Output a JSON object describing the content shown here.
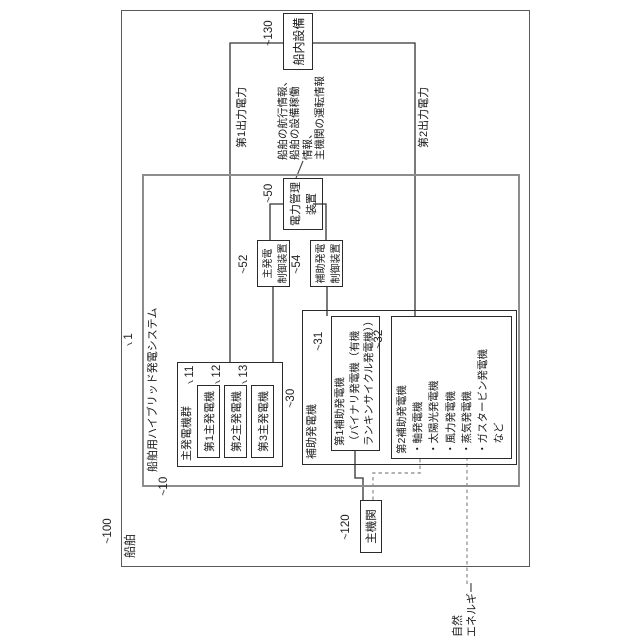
{
  "figure": {
    "tilde": "~",
    "ship": {
      "name": "船舶",
      "ref": "100"
    },
    "system": {
      "name": "船舶用ハイブリッド発電システム",
      "ref": "1"
    },
    "main_generator_group": {
      "name": "主発電機群",
      "ref": "10",
      "generators": [
        {
          "name": "第1主発電機",
          "ref": "11"
        },
        {
          "name": "第2主発電機",
          "ref": "12"
        },
        {
          "name": "第3主発電機",
          "ref": "13"
        }
      ]
    },
    "auxiliary_generator": {
      "name": "補助発電機",
      "ref": "30",
      "aux1": {
        "ref": "31",
        "lines": [
          "第1補助発電機",
          "（バイナリ発電機（有機",
          "ランキンサイクル発電機））"
        ]
      },
      "aux2": {
        "ref": "32",
        "lines": [
          "第2補助発電機",
          "・軸発電機",
          "・太陽光発電機",
          "・風力発電機",
          "・蒸気発電機",
          "・ガスタービン発電機",
          "　など"
        ]
      }
    },
    "power_management": {
      "ref": "50",
      "lines": [
        "電力管理",
        "装置"
      ]
    },
    "main_gen_control": {
      "ref": "52",
      "lines": [
        "主発電",
        "制御装置"
      ]
    },
    "aux_gen_control": {
      "ref": "54",
      "lines": [
        "補助発電",
        "制御装置"
      ]
    },
    "main_engine": {
      "name": "主機関",
      "ref": "120"
    },
    "onboard_equipment": {
      "name": "船内設備",
      "ref": "130"
    },
    "labels": {
      "output_power_1": "第1出力電力",
      "output_power_2": "第2出力電力",
      "info": [
        "船舶の航行情報、",
        "船舶の設備稼働",
        "情報、",
        "主機関の運転情報"
      ],
      "natural_energy": [
        "自然",
        "エネルギー"
      ]
    }
  }
}
